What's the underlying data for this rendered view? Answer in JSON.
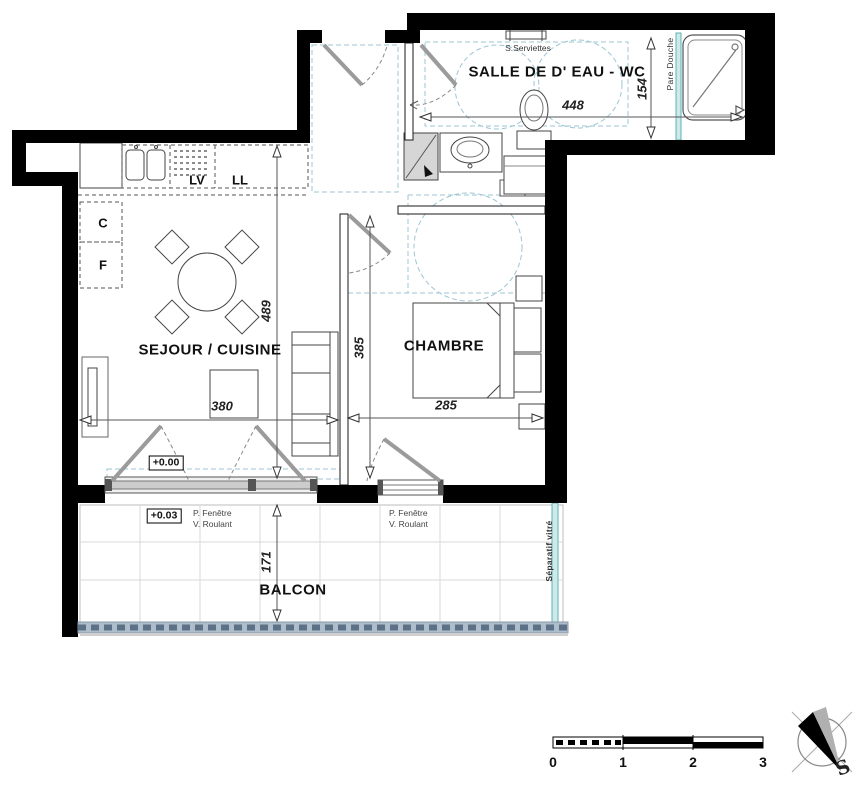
{
  "plan": {
    "rooms": {
      "bathroom": {
        "label": "SALLE DE D' EAU - WC"
      },
      "living": {
        "label": "SEJOUR / CUISINE"
      },
      "bedroom": {
        "label": "CHAMBRE"
      },
      "balcony": {
        "label": "BALCON"
      }
    },
    "dimensions": {
      "bathroom_width": "448",
      "bathroom_depth": "154",
      "living_height": "489",
      "living_width": "380",
      "bedroom_height": "385",
      "bedroom_width": "285",
      "balcony_depth": "171"
    },
    "annotations": {
      "towel_dryer": "S.Serviettes",
      "shower_screen": "Pare Douche",
      "dishwasher": "LV",
      "washing_machine": "LL",
      "cupboard": "C",
      "fridge": "F",
      "level_main": "+0.00",
      "level_balcony": "+0.03",
      "window_type_line1": "P. Fenêtre",
      "window_type_line2": "V. Roulant",
      "glass_divider": "Séparatif vitré"
    },
    "scale_bar": {
      "ticks": [
        "0",
        "1",
        "2",
        "3"
      ]
    },
    "compass": {
      "south_label": "S"
    },
    "colors": {
      "wall": "#000000",
      "guide_dashed": "#9cc6d4",
      "glass": "#5fb3b7",
      "door_leaf": "#9b9b9b",
      "railing": "#5d7186"
    }
  }
}
